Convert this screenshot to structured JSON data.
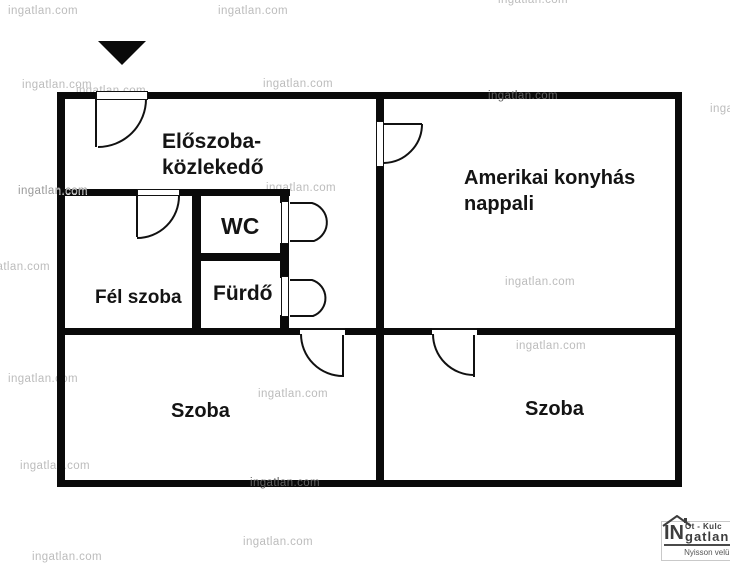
{
  "watermark": {
    "text": "ingatlan.com"
  },
  "rooms": [
    {
      "id": "eloszoba-kozlekedo",
      "lines": [
        "Előszoba-",
        "közlekedő"
      ]
    },
    {
      "id": "amerikai-konyhas-nappali",
      "lines": [
        "Amerikai konyhás",
        "nappali"
      ]
    },
    {
      "id": "wc",
      "lines": [
        "WC"
      ]
    },
    {
      "id": "furdo",
      "lines": [
        "Fürdő"
      ]
    },
    {
      "id": "fel-szoba",
      "lines": [
        "Fél szoba"
      ]
    },
    {
      "id": "szoba-bal",
      "lines": [
        "Szoba"
      ]
    },
    {
      "id": "szoba-jobb",
      "lines": [
        "Szoba"
      ]
    }
  ],
  "logo": {
    "top_line": "Öt - Kulc",
    "brand_in": "IN",
    "brand_rest": "gatlan",
    "tagline": "Nyisson velün"
  },
  "colors": {
    "wall": "#0a0a0a",
    "watermark_light": "#bcbcbc",
    "watermark_dark": "#606060",
    "label": "#141414",
    "logo": "#3d3d3d"
  }
}
